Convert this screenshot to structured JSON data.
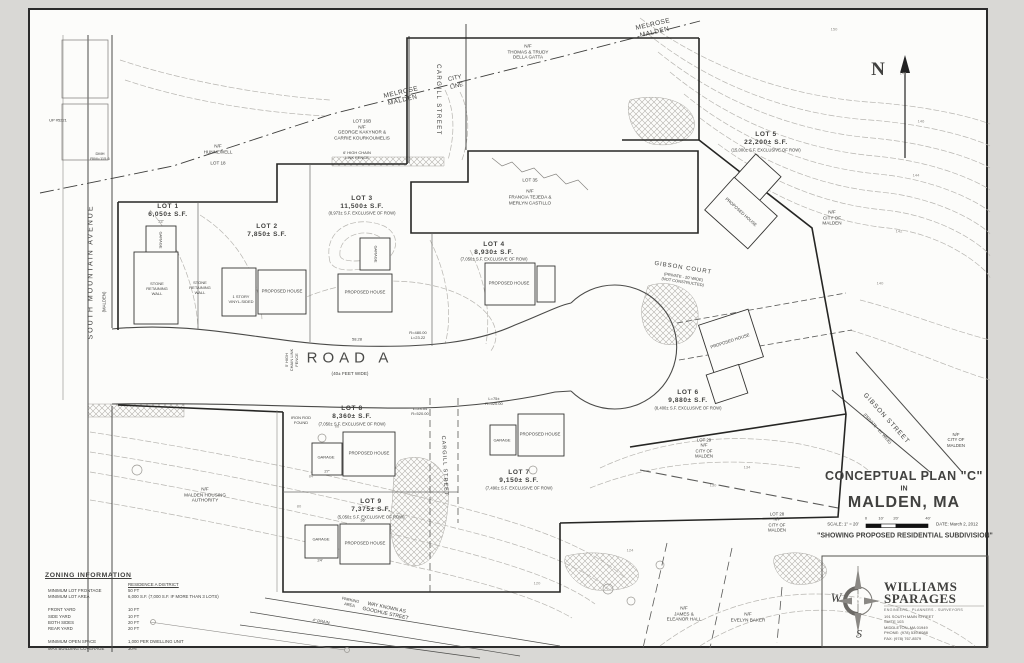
{
  "title_block": {
    "line1": "CONCEPTUAL PLAN \"C\"",
    "line2": "IN",
    "line3": "MALDEN, MA",
    "scale_label": "SCALE: 1\" = 20'",
    "date_label": "DATE: March 2, 2012",
    "subtitle": "\"SHOWING PROPOSED RESIDENTIAL SUBDIVISION\"",
    "ticks": [
      "0",
      "10'",
      "20'",
      "40'"
    ]
  },
  "logo": {
    "name": [
      "WILLIAMS",
      "SPARAGES"
    ],
    "tagline": "ENGINEERS - PLANNERS - SURVEYORS",
    "address": [
      "191 SOUTH MAIN STREET",
      "SUITE 103",
      "MIDDLETON, MA 01949",
      "PHONE: (978) 539-8088",
      "FAX: (978) 767-8579"
    ],
    "w": "W",
    "s": "S",
    "amp": "&"
  },
  "north": "N",
  "zoning": {
    "title": "ZONING INFORMATION",
    "district": "RESIDENCE A DISTRICT",
    "labels": [
      "MINIMUM LOT FRONTAGE",
      "MINIMUM LOT AREA",
      "",
      "FRONT YARD",
      "SIDE YARD",
      "BOTH SIDES",
      "REAR YARD",
      "",
      "MINIMUM OPEN SPACE",
      "MAX BUILDING COVERAGE"
    ],
    "values": [
      "50 FT",
      "6,000 S.F. (7,000 S.F. IF MORE THAN 3 LOTS)",
      "",
      "10 FT",
      "10 FT",
      "20 FT",
      "20 FT",
      "",
      "1,000 PER DWELLING UNIT",
      "30%"
    ]
  },
  "lots": [
    {
      "main": [
        "LOT 1",
        "6,050± S.F."
      ],
      "note": ""
    },
    {
      "main": [
        "LOT 2",
        "7,850± S.F."
      ],
      "note": ""
    },
    {
      "main": [
        "LOT 3",
        "11,500± S.F."
      ],
      "note": "(8,973± S.F. EXCLUSIVE OF ROW)"
    },
    {
      "main": [
        "LOT 4",
        "8,930± S.F."
      ],
      "note": "(7,050± S.F. EXCLUSIVE OF ROW)"
    },
    {
      "main": [
        "LOT 5",
        "22,200± S.F."
      ],
      "note": "(15,000± S.F. EXCLUSIVE OF ROW)"
    },
    {
      "main": [
        "LOT 6",
        "9,880± S.F."
      ],
      "note": "(8,400± S.F. EXCLUSIVE OF ROW)"
    },
    {
      "main": [
        "LOT 7",
        "9,150± S.F."
      ],
      "note": "(7,490± S.F. EXCLUSIVE OF ROW)"
    },
    {
      "main": [
        "LOT 8",
        "8,360± S.F."
      ],
      "note": "(7,050± S.F. EXCLUSIVE OF ROW)"
    },
    {
      "main": [
        "LOT 9",
        "7,375± S.F."
      ],
      "note": "(5,050± S.F. EXCLUSIVE OF ROW)"
    }
  ],
  "owners": {
    "hunnewell": [
      "N/F",
      "HUNNEWELL",
      "",
      "LOT 18"
    ],
    "kakynor": [
      "LOT 16B",
      "N/F",
      "GEORGE KAKYNOR &",
      "CARRIE KOURKOUMELIS"
    ],
    "della_gatta": [
      "N/F",
      "THOMAS & TRUDY",
      "DELLA GATTA"
    ],
    "tejeda": [
      "LOT 35",
      "",
      "N/F",
      "FRANCIA TEJEDA &",
      "MERLYN CASTILLO"
    ],
    "city_east": [
      "N/F",
      "CITY OF",
      "MALDEN"
    ],
    "lot29_city": [
      "LOT 29",
      "N/F",
      "CITY OF",
      "MALDEN"
    ],
    "lot28_city": [
      "LOT 28",
      "N/F",
      "CITY OF",
      "MALDEN"
    ],
    "housing": [
      "N/F",
      "MALDEN HOUSING",
      "AUTHORITY"
    ],
    "hall": [
      "N/F",
      "JAMES &",
      "ELEANOR HALL"
    ],
    "baker": [
      "N/F",
      "EVELYN BAKER"
    ],
    "city_gibson": [
      "N/F",
      "CITY OF",
      "MALDEN"
    ]
  },
  "streets": {
    "south_mountain": "SOUTH  MOUNTAIN  AVENUE",
    "south_mountain_note": "(MALDEN)",
    "cargill_upper": "CARGILL  STREET",
    "cargill_lower": "CARGILL  STREET",
    "city_line_a": [
      "MELROSE",
      "MALDEN"
    ],
    "city_line_b": [
      "CITY",
      "LINE"
    ],
    "city_line_c": [
      "MELROSE",
      "MALDEN"
    ],
    "road_a": "ROAD  A",
    "road_a_note": "(40± FEET WIDE)",
    "gibson_court": "GIBSON  COURT",
    "gibson_court_notes": [
      "(PRIVATE - 20' WIDE)",
      "(NOT CONSTRUCTED)"
    ],
    "gibson_street": "GIBSON  STREET",
    "gibson_street_note": "(PRIVATE - 20' WIDE)",
    "goodhue": [
      "WAY KNOWN AS",
      "GOODHUE STREET"
    ]
  },
  "buildings": {
    "house": "PROPOSED HOUSE",
    "garage": "GARAGE"
  },
  "annotations": {
    "curve1": [
      "R=480.00",
      "L=23.22"
    ],
    "len1": "58.28",
    "curve2": [
      "L=23.04",
      "R=520.00"
    ],
    "curve3": [
      "L=75±",
      "R=520.00"
    ],
    "stone_wall": [
      "STONE",
      "RETAINING",
      "WALL"
    ],
    "iron_rod": [
      "IRON ROD",
      "FOUND"
    ],
    "dmh": [
      "DMH",
      "RIM=115.6"
    ],
    "up_pole": "UP #5221",
    "fence5": [
      "5' HIGH",
      "CHAIN LINK",
      "FENCE"
    ],
    "fence6": [
      "6' HIGH CHAIN",
      "LINK FENCE"
    ],
    "drain": "4\" DRAIN",
    "parking": [
      "PARKING",
      "AREA"
    ],
    "vinyl": [
      "1 STORY",
      "VINYL-SIDED"
    ],
    "d1": "24'",
    "d2": "36'",
    "d3": "22'",
    "d4": "27'"
  },
  "contours": [
    "150",
    "148",
    "146",
    "144",
    "142",
    "140",
    "134",
    "130",
    "124",
    "120",
    "88",
    "84",
    "80"
  ]
}
